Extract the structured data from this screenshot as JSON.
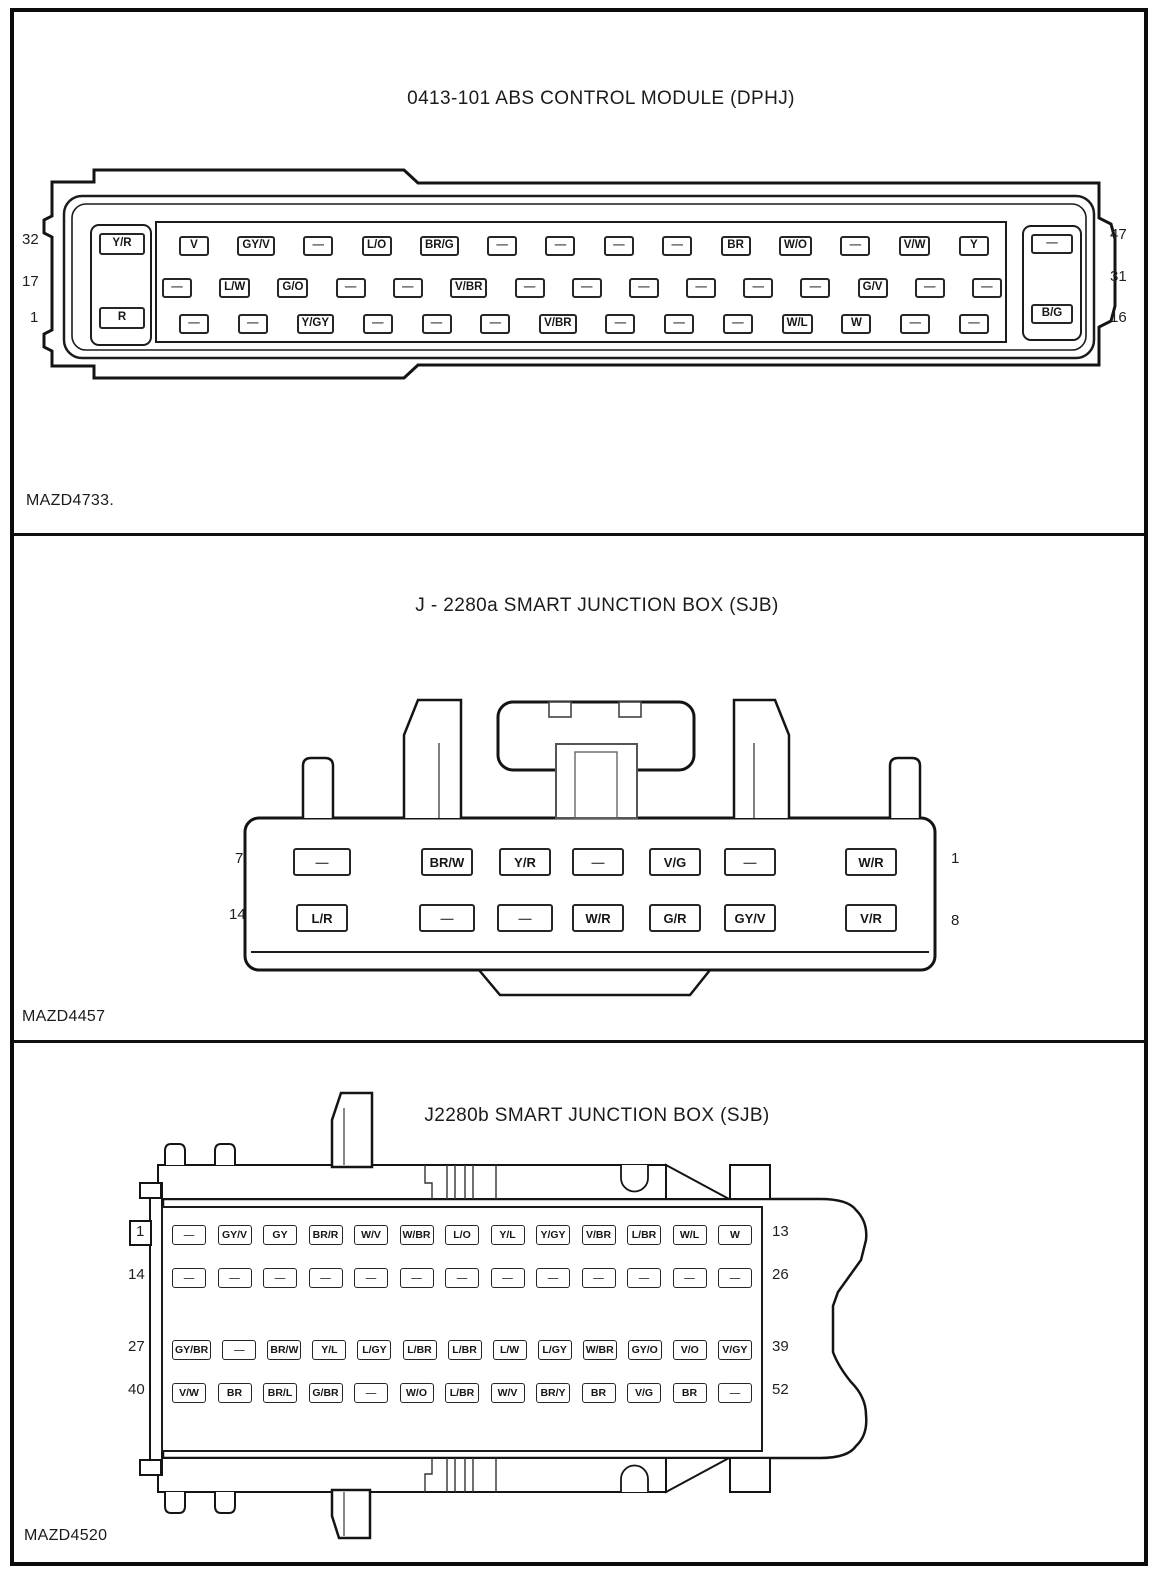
{
  "sections": [
    {
      "title": "0413-101 ABS CONTROL MODULE (DPHJ)",
      "caption": "MAZD4733.",
      "connector": {
        "left_pin_numbers": [
          "32",
          "17",
          "1"
        ],
        "right_pin_numbers": [
          "47",
          "31",
          "16"
        ],
        "corner_pins": {
          "top_left": "Y/R",
          "bottom_left": "R",
          "top_right": "—",
          "bottom_right": "B/G"
        },
        "rows": [
          {
            "pins": [
              "V",
              "GY/V",
              "—",
              "L/O",
              "BR/G",
              "—",
              "—",
              "—",
              "—",
              "BR",
              "W/O",
              "—",
              "V/W",
              "Y"
            ]
          },
          {
            "pins": [
              "—",
              "L/W",
              "G/O",
              "—",
              "—",
              "V/BR",
              "—",
              "—",
              "—",
              "—",
              "—",
              "—",
              "G/V",
              "—",
              "—"
            ]
          },
          {
            "pins": [
              "—",
              "—",
              "Y/GY",
              "—",
              "—",
              "—",
              "V/BR",
              "—",
              "—",
              "—",
              "W/L",
              "W",
              "—",
              "—"
            ]
          }
        ]
      }
    },
    {
      "title": "J - 2280a SMART JUNCTION BOX (SJB)",
      "caption": "MAZD4457",
      "connector": {
        "left_pin_numbers": [
          "7",
          "14"
        ],
        "right_pin_numbers": [
          "1",
          "8"
        ],
        "rows": [
          {
            "pins": [
              "—",
              "BR/W",
              "Y/R",
              "—",
              "V/G",
              "—",
              "W/R"
            ]
          },
          {
            "pins": [
              "L/R",
              "—",
              "—",
              "W/R",
              "G/R",
              "GY/V",
              "V/R"
            ]
          }
        ]
      }
    },
    {
      "title": "J2280b SMART JUNCTION BOX (SJB)",
      "caption": "MAZD4520",
      "connector": {
        "left_pin_numbers": [
          "1",
          "14",
          "27",
          "40"
        ],
        "right_pin_numbers": [
          "13",
          "26",
          "39",
          "52"
        ],
        "rows": [
          {
            "pins": [
              "—",
              "GY/V",
              "GY",
              "BR/R",
              "W/V",
              "W/BR",
              "L/O",
              "Y/L",
              "Y/GY",
              "V/BR",
              "L/BR",
              "W/L",
              "W"
            ]
          },
          {
            "pins": [
              "—",
              "—",
              "—",
              "—",
              "—",
              "—",
              "—",
              "—",
              "—",
              "—",
              "—",
              "—",
              "—"
            ]
          },
          {
            "pins": [
              "GY/BR",
              "—",
              "BR/W",
              "Y/L",
              "L/GY",
              "L/BR",
              "L/BR",
              "L/W",
              "L/GY",
              "W/BR",
              "GY/O",
              "V/O",
              "V/GY"
            ]
          },
          {
            "pins": [
              "V/W",
              "BR",
              "BR/L",
              "G/BR",
              "—",
              "W/O",
              "L/BR",
              "W/V",
              "BR/Y",
              "BR",
              "V/G",
              "BR",
              "—"
            ]
          }
        ]
      }
    }
  ]
}
